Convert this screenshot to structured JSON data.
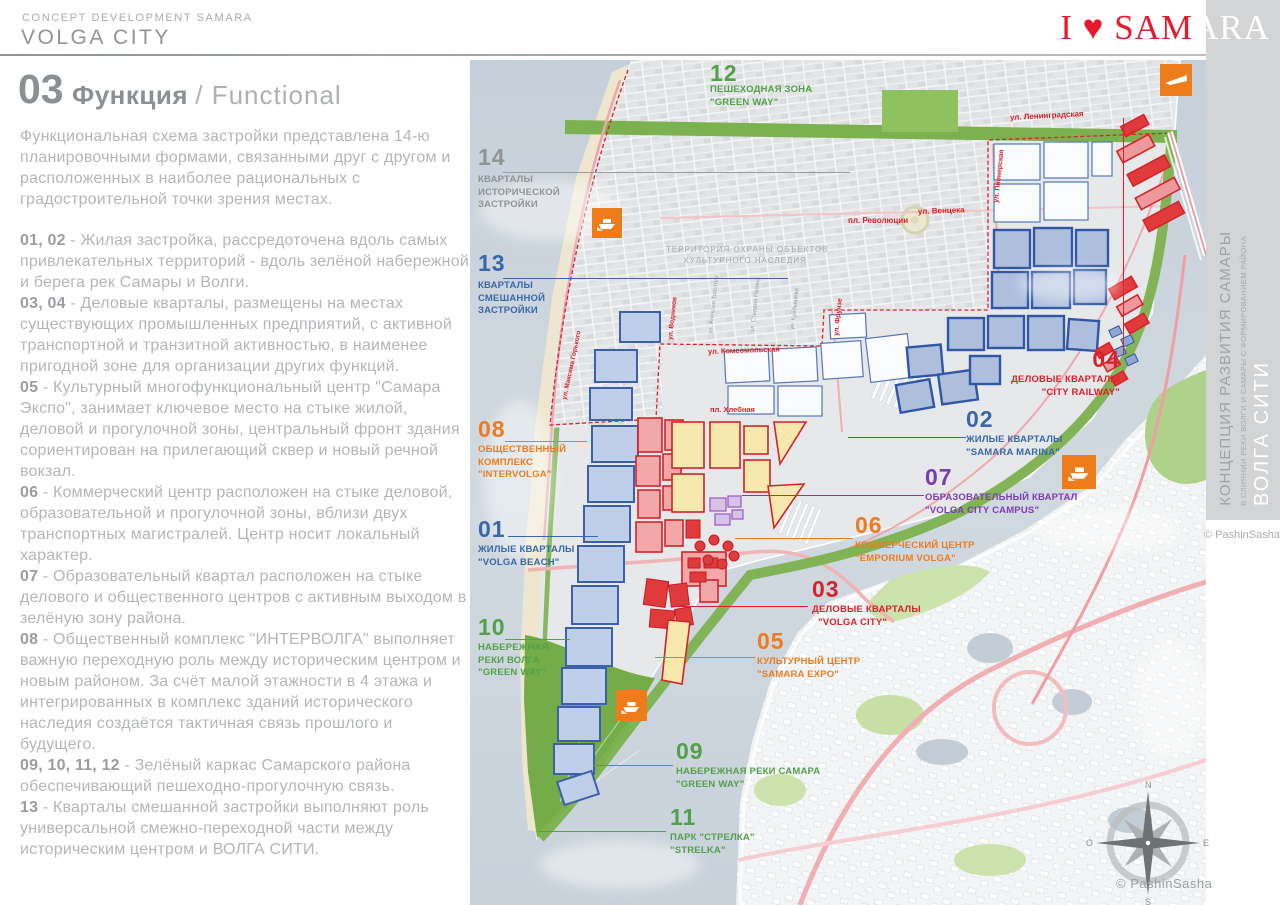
{
  "header": {
    "kicker": "CONCEPT DEVELOPMENT SAMARA",
    "title": "VOLGA CITY"
  },
  "logo": {
    "red": "I ♥ SAM",
    "white": "ARA"
  },
  "section": {
    "number": "03",
    "title_ru": "Функция",
    "title_en": "/ Functional"
  },
  "intro": "Функциональная схема застройки представлена 14-ю планировочными формами, связанными друг с другом и расположенных в наиболее рациональных с градостроительной точки зрения местах.",
  "paragraphs": [
    {
      "prefix": "01, 02",
      "body": " - Жилая застройка,  рассредоточена вдоль самых привлекательных территорий - вдоль зелёной набережной и берега рек Самары и Волги."
    },
    {
      "prefix": "03, 04",
      "body": " - Деловые кварталы, размещены на местах существующих промышленных предприятий, с активной транспортной и транзитной активностью, в наименее пригодной зоне для организации других функций."
    },
    {
      "prefix": "05",
      "body": " - Культурный многофункциональный центр \"Самара Экспо\", занимает ключевое место на стыке жилой, деловой и прогулочной зоны, центральный фронт здания сориентирован на прилегающий сквер и новый речной вокзал."
    },
    {
      "prefix": "06",
      "body": " - Коммерческий центр расположен на стыке деловой, образовательной и прогулочной зоны, вблизи двух транспортных магистралей. Центр носит локальный характер."
    },
    {
      "prefix": "07",
      "body": " - Образовательный квартал расположен на стыке делового и общественного центров с активным выходом в зелёную зону района."
    },
    {
      "prefix": "08",
      "body": " - Общественный комплекс \"ИНТЕРВОЛГА\" выполняет важную переходную роль между историческим центром и новым районом.  За счёт малой этажности в 4 этажа и интегрированных в комплекс зданий исторического наследия создаётся тактичная связь прошлого и будущего."
    },
    {
      "prefix": "09, 10, 11, 12",
      "body": " - Зелёный каркас Самарского района обеспечивающий пешеходно-прогулочную связь."
    },
    {
      "prefix": "13",
      "body": " - Кварталы смешанной застройки выполняют роль универсальной смежно-переходной части между историческим центром и ВОЛГА СИТИ."
    }
  ],
  "map": {
    "labels": [
      {
        "num": "01",
        "line1": "ЖИЛЫЕ КВАРТАЛЫ",
        "line2": "\"VOLGA BEACH\""
      },
      {
        "num": "02",
        "line1": "ЖИЛЫЕ КВАРТАЛЫ",
        "line2": "\"SAMARA MARINA\""
      },
      {
        "num": "03",
        "line1": "ДЕЛОВЫЕ КВАРТАЛЫ",
        "line2": "\"VOLGA CITY\""
      },
      {
        "num": "04",
        "line1": "ДЕЛОВЫЕ КВАРТАЛЫ",
        "line2": "\"CITY RAILWAY\""
      },
      {
        "num": "05",
        "line1": "КУЛЬТУРНЫЙ ЦЕНТР",
        "line2": "\"SAMARA EXPO\""
      },
      {
        "num": "06",
        "line1": "КОММЕРЧЕСКИЙ ЦЕНТР",
        "line2": "\"EMPORIUM VOLGA\""
      },
      {
        "num": "07",
        "line1": "ОБРАЗОВАТЕЛЬНЫЙ КВАРТАЛ",
        "line2": "\"VOLGA CITY CAMPUS\""
      },
      {
        "num": "08",
        "line1": "ОБЩЕСТВЕННЫЙ",
        "line2": "КОМПЛЕКС",
        "line3": "\"INTERVOLGA\""
      },
      {
        "num": "09",
        "line1": "НАБЕРЕЖНАЯ РЕКИ САМАРА",
        "line2": "\"GREEN WAY\""
      },
      {
        "num": "10",
        "line1": "НАБЕРЕЖНАЯ",
        "line2": "РЕКИ ВОЛГА",
        "line3": "\"GREEN WAY\""
      },
      {
        "num": "11",
        "line1": "ПАРК \"СТРЕЛКА\"",
        "line2": "\"STRELKA\""
      },
      {
        "num": "12",
        "line1": "ПЕШЕХОДНАЯ ЗОНА",
        "line2": "\"GREEN WAY\""
      },
      {
        "num": "13",
        "line1": "КВАРТАЛЫ",
        "line2": "СМЕШАННОЙ",
        "line3": "ЗАСТРОЙКИ"
      },
      {
        "num": "14",
        "line1": "КВАРТАЛЫ",
        "line2": "ИСТОРИЧЕСКОЙ",
        "line3": "ЗАСТРОЙКИ"
      }
    ],
    "streets": {
      "leningradskaya": "ул. Ленинградская",
      "venceka": "ул. Венцека",
      "revolutsii": "пл. Революции",
      "pionerskaya": "ул. Пионерская",
      "frunze": "ул. Фрунзе",
      "komsomolskaya": "ул. Комсомольская",
      "khlebnaya": "пл. Хлебная",
      "vodnikov": "ул. Водников",
      "gorkogo": "ул. Максима Горького",
      "tolstogo": "ул. Алексея Толстого",
      "razina": "ул. Степана Разина",
      "kuybysheva": "ул. Куйбышева"
    },
    "protected_area": {
      "line1": "ТЕРРИТОРИЯ ОХРАНЫ ОБЪЕКТОВ",
      "line2": "КУЛЬТУРНОГО НАСЛЕДИЯ"
    },
    "compass": {
      "n": "N",
      "e": "E",
      "s": "S",
      "w": "O"
    }
  },
  "sidebar": {
    "title": "КОНЦЕПЦИЯ РАЗВИТИЯ САМАРЫ",
    "subtitle": "В СЛИЯНИИ РЕКИ ВОЛГИ И САМАРЫ С ФОРМИРОВАНИЕМ РАЙОНА",
    "city": "ВОЛГА СИТИ",
    "credit": "© PashinSasha"
  },
  "footer": {
    "credit": "© PashinSasha"
  },
  "theme": {
    "logo_red": "#e8192c",
    "green": "#54a049",
    "blue": "#3a67a8",
    "red": "#d6242b",
    "orange": "#ee7b1e",
    "purple": "#7e3bb5",
    "gray": "#8f9496",
    "water": "#c9d3dc",
    "land": "#e7e8ea",
    "sand": "#eee6cf",
    "park_green": "#7cb14f"
  }
}
